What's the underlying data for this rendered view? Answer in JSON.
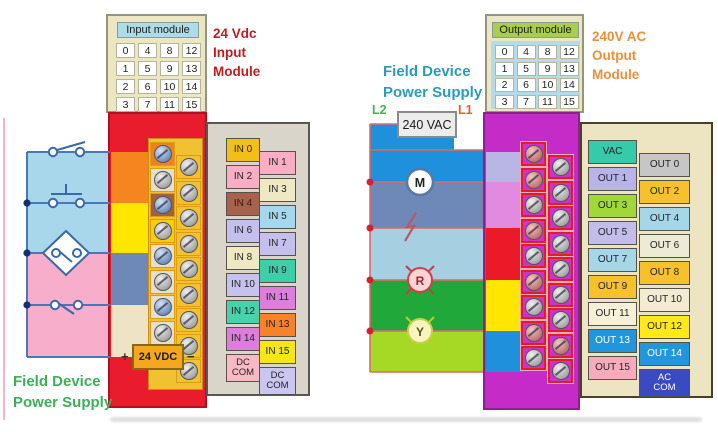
{
  "left_module": {
    "name_label": "Input module",
    "grid": [
      [
        "0",
        "4",
        "8",
        "12"
      ],
      [
        "1",
        "5",
        "9",
        "13"
      ],
      [
        "2",
        "6",
        "10",
        "14"
      ],
      [
        "3",
        "7",
        "11",
        "15"
      ]
    ],
    "title_lines": [
      "24 Vdc",
      "Input",
      "Module"
    ],
    "title_color": "#c01b20",
    "body_color": "#e81c2c",
    "channels_left": [
      {
        "label": "IN 0",
        "bg": "#f2be18"
      },
      {
        "label": "IN 2",
        "bg": "#f8afc6"
      },
      {
        "label": "IN 4",
        "bg": "#a5634d",
        "fg": "#3a1c10"
      },
      {
        "label": "IN 6",
        "bg": "#c5bfee"
      },
      {
        "label": "IN 8",
        "bg": "#efe9c3"
      },
      {
        "label": "IN 10",
        "bg": "#c5c3ee"
      },
      {
        "label": "IN 12",
        "bg": "#46d3ac"
      },
      {
        "label": "IN 14",
        "bg": "#dc7fdc"
      },
      {
        "label": "DC\nCOM",
        "bg": "#f8b8c4",
        "tall": true
      }
    ],
    "channels_right": [
      {
        "label": "IN 1",
        "bg": "#f8afc6"
      },
      {
        "label": "IN 3",
        "bg": "#efe9c3"
      },
      {
        "label": "IN 5",
        "bg": "#a5d8ef"
      },
      {
        "label": "IN 7",
        "bg": "#c5bfee"
      },
      {
        "label": "IN 9",
        "bg": "#3ecfa8"
      },
      {
        "label": "IN 11",
        "bg": "#dc7fdc"
      },
      {
        "label": "IN 13",
        "bg": "#f8822a"
      },
      {
        "label": "IN 15",
        "bg": "#f5e614"
      },
      {
        "label": "DC\nCOM",
        "bg": "#c9c6f0",
        "tall": true
      }
    ],
    "terminals": {
      "left_col": {
        "count": 9,
        "cells": [
          "#f08020",
          "#e4e0d0",
          "#a06048",
          "#f5d000",
          "#e4e0d0",
          "#e4e0d0",
          "#e4e0d0",
          "#e4e0d0",
          "#e4e0d0"
        ],
        "screws": [
          "blue",
          "silver",
          "blue",
          "silver",
          "blue",
          "silver",
          "blue",
          "silver",
          "blue"
        ]
      },
      "right_col": {
        "count": 9,
        "cells": [
          "#f0c232",
          "#f0c232",
          "#f0c232",
          "#f0c232",
          "#f0c232",
          "#f0c232",
          "#f0c232",
          "#f0c232",
          "#f0c232"
        ],
        "screws": [
          "silver",
          "silver",
          "silver",
          "silver",
          "silver",
          "silver",
          "silver",
          "silver",
          "silver"
        ]
      }
    },
    "field": {
      "supply_label": "24 VDC",
      "plus": "+",
      "minus": "−",
      "caption_lines": [
        "Field Device",
        "Power Supply"
      ],
      "caption_color": "#3fae5a"
    }
  },
  "right_module": {
    "name_label": "Output module",
    "grid": [
      [
        "0",
        "4",
        "8",
        "12"
      ],
      [
        "1",
        "5",
        "9",
        "13"
      ],
      [
        "2",
        "6",
        "10",
        "14"
      ],
      [
        "3",
        "7",
        "11",
        "15"
      ]
    ],
    "title_lines": [
      "240V AC",
      "Output",
      "Module"
    ],
    "title_color": "#e8913c",
    "body_color": "#c52bc7",
    "channels_left": [
      {
        "label": "VAC",
        "bg": "#35cbaa"
      },
      {
        "label": "OUT 1",
        "bg": "#b9b4e8"
      },
      {
        "label": "OUT 3",
        "bg": "#9fd838"
      },
      {
        "label": "OUT 5",
        "bg": "#c3bee9"
      },
      {
        "label": "OUT 7",
        "bg": "#a5d7e8"
      },
      {
        "label": "OUT 9",
        "bg": "#f7c12b"
      },
      {
        "label": "OUT 11",
        "bg": "#f6f0d8"
      },
      {
        "label": "OUT 13",
        "bg": "#2196dc",
        "fg": "#ffffff"
      },
      {
        "label": "OUT 15",
        "bg": "#f7abbd"
      }
    ],
    "channels_right": [
      {
        "label": "OUT 0",
        "bg": "#c6c6c6"
      },
      {
        "label": "OUT 2",
        "bg": "#f7c12b"
      },
      {
        "label": "OUT 4",
        "bg": "#a5d7e8"
      },
      {
        "label": "OUT 6",
        "bg": "#edead6"
      },
      {
        "label": "OUT 8",
        "bg": "#f7c12b"
      },
      {
        "label": "OUT 10",
        "bg": "#f3ecd2"
      },
      {
        "label": "OUT 12",
        "bg": "#ffe81c"
      },
      {
        "label": "OUT 14",
        "bg": "#2196dc",
        "fg": "#ffffff"
      },
      {
        "label": "AC\nCOM",
        "bg": "#3a4ac0",
        "fg": "#ffffff",
        "tall": true
      }
    ],
    "terminals": {
      "left_col": {
        "count": 9,
        "cells": [
          "#cc32cc",
          "#cc32cc",
          "#cc32cc",
          "#cc32cc",
          "#cc32cc",
          "#cc32cc",
          "#cc32cc",
          "#cc32cc",
          "#cc32cc"
        ],
        "screws": [
          "red",
          "red",
          "silver",
          "red",
          "silver",
          "red",
          "silver",
          "red",
          "silver"
        ]
      },
      "right_col": {
        "count": 9,
        "cells": [
          "#cc32cc",
          "#cc32cc",
          "#cc32cc",
          "#cc32cc",
          "#cc32cc",
          "#cc32cc",
          "#cc32cc",
          "#cc32cc",
          "#cc32cc"
        ],
        "screws": [
          "silver",
          "silver",
          "silver",
          "silver",
          "silver",
          "silver",
          "silver",
          "red",
          "silver"
        ]
      }
    },
    "field": {
      "supply_label": "240 VAC",
      "l2": "L2",
      "l1": "L1",
      "l2_color": "#4cae50",
      "l1_color": "#f05830",
      "caption_lines": [
        "Field Device",
        "Power Supply"
      ],
      "caption_color": "#2a9cb8",
      "devices": [
        {
          "symbol": "M",
          "name": "motor"
        },
        {
          "symbol": "",
          "name": "solenoid"
        },
        {
          "symbol": "R",
          "name": "red-pilot-lamp"
        },
        {
          "symbol": "Y",
          "name": "yellow-pilot-lamp"
        }
      ]
    }
  }
}
